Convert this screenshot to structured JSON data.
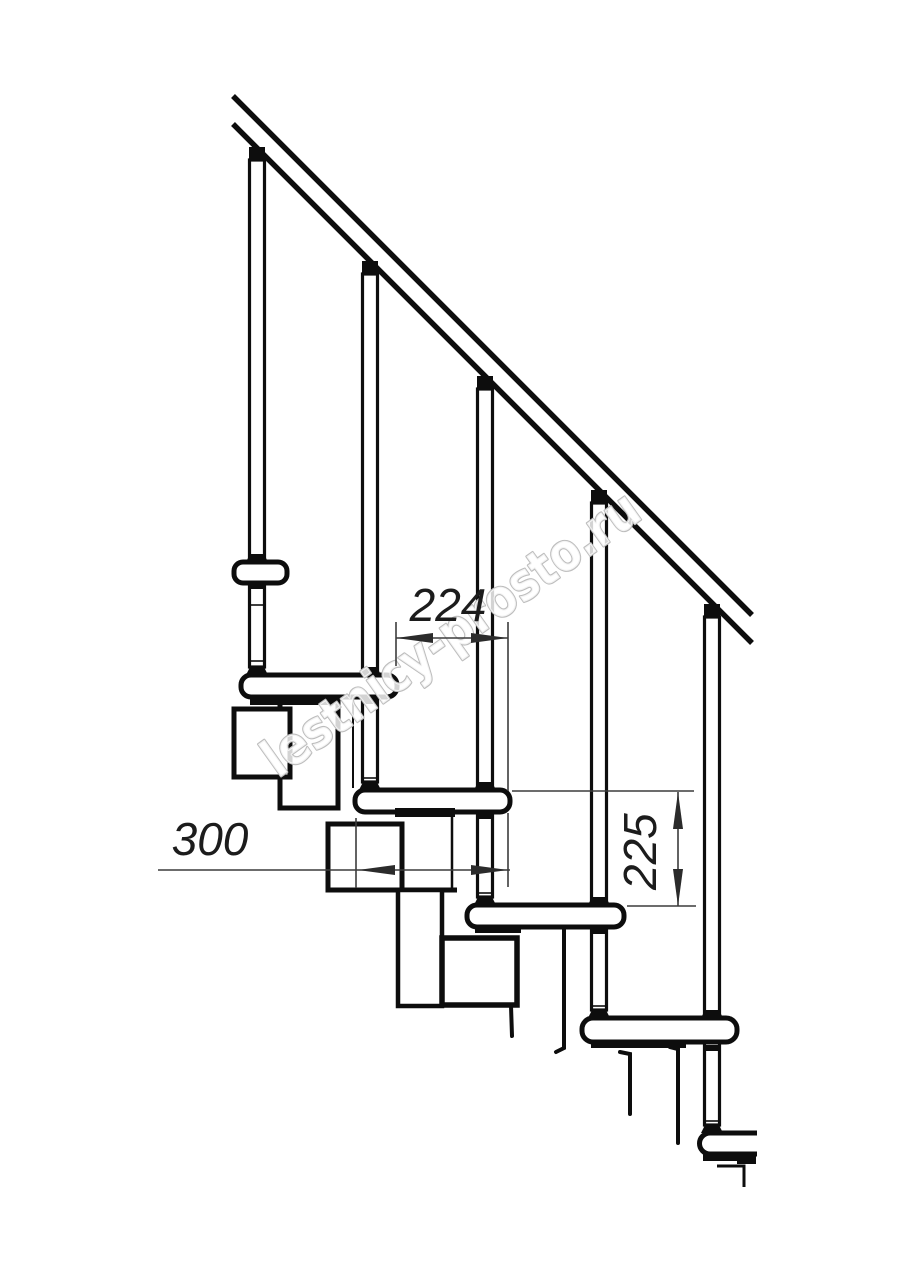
{
  "drawing": {
    "title": "staircase-side-view-technical-drawing",
    "dimensions": {
      "going": {
        "value": "224"
      },
      "tread_depth": {
        "value": "300"
      },
      "riser_height": {
        "value": "225"
      }
    },
    "watermark": {
      "text": "lestnicy-prosto.ru",
      "outline_color": "#bdbdbd",
      "fill_color": "rgba(255,255,255,0.82)"
    },
    "style": {
      "line_color": "#0d0d0d",
      "dim_line_color": "#3c3c3c",
      "dim_text_color": "#1c1c1c",
      "background": "#ffffff"
    }
  }
}
